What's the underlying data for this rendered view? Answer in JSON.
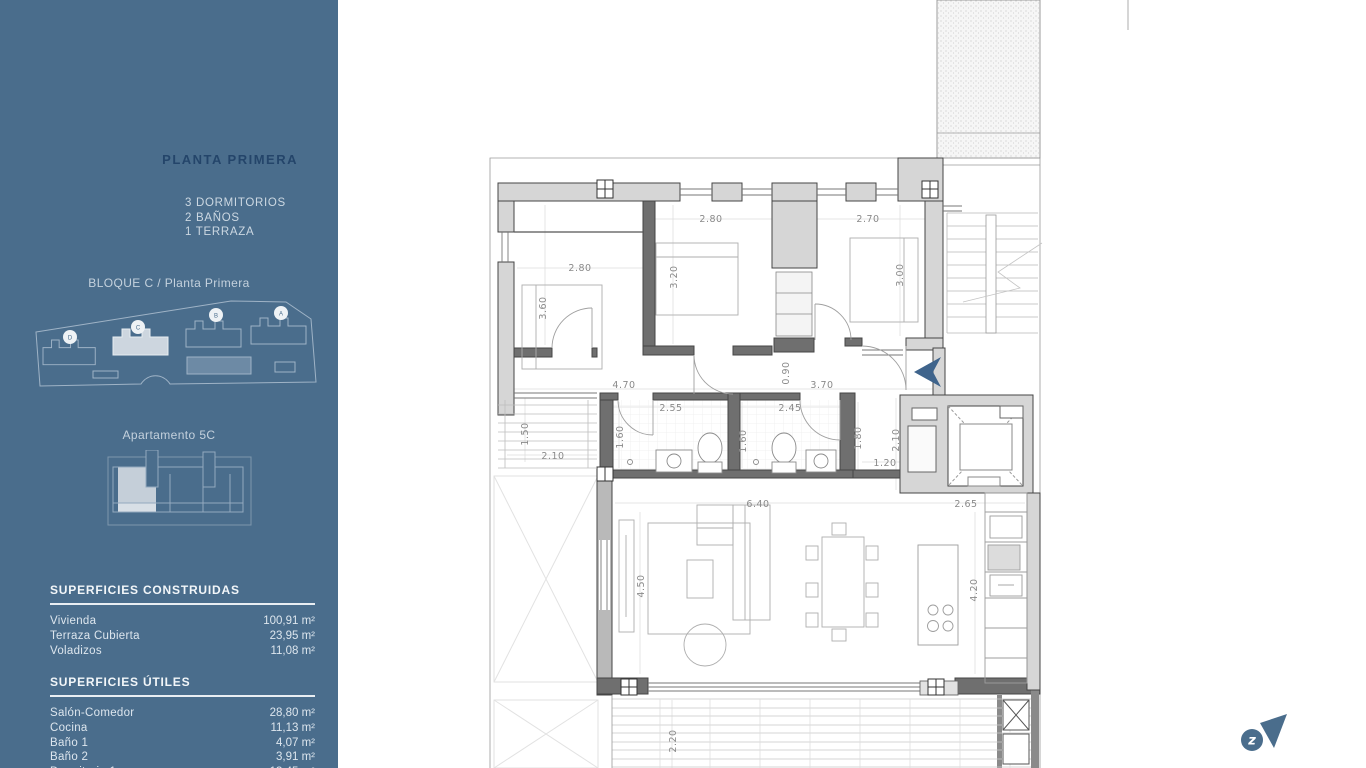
{
  "sidebar": {
    "title": "PLANTA PRIMERA",
    "specs": [
      "3 DORMITORIOS",
      "2 BAÑOS",
      "1 TERRAZA"
    ],
    "block_label": "BLOQUE C / Planta Primera",
    "site_blocks": [
      "D",
      "C",
      "B",
      "A"
    ],
    "apartment_label": "Apartamento 5C",
    "surfaces_built": {
      "heading": "SUPERFICIES CONSTRUIDAS",
      "rows": [
        {
          "label": "Vivienda",
          "value": "100,91 m²"
        },
        {
          "label": "Terraza Cubierta",
          "value": "23,95 m²"
        },
        {
          "label": "Voladizos",
          "value": "11,08 m²"
        }
      ]
    },
    "surfaces_useful": {
      "heading": "SUPERFICIES ÚTILES",
      "rows": [
        {
          "label": "Salón-Comedor",
          "value": "28,80 m²"
        },
        {
          "label": "Cocina",
          "value": "11,13 m²"
        },
        {
          "label": "Baño 1",
          "value": "4,07 m²"
        },
        {
          "label": "Baño 2",
          "value": "3,91 m²"
        },
        {
          "label": "Dormitorio 1",
          "value": "13,45 m²"
        }
      ]
    }
  },
  "floor_plan": {
    "dimension_labels": [
      {
        "v": "2.80",
        "x": 580,
        "y": 271,
        "r": 0
      },
      {
        "v": "3.60",
        "x": 546,
        "y": 308,
        "r": 1
      },
      {
        "v": "2.80",
        "x": 711,
        "y": 222,
        "r": 0
      },
      {
        "v": "3.20",
        "x": 677,
        "y": 277,
        "r": 1
      },
      {
        "v": "2.70",
        "x": 868,
        "y": 222,
        "r": 0
      },
      {
        "v": "3.00",
        "x": 903,
        "y": 275,
        "r": 1
      },
      {
        "v": "4.70",
        "x": 624,
        "y": 388,
        "r": 0
      },
      {
        "v": "0.90",
        "x": 789,
        "y": 373,
        "r": 1
      },
      {
        "v": "3.70",
        "x": 822,
        "y": 388,
        "r": 0
      },
      {
        "v": "2.55",
        "x": 671,
        "y": 411,
        "r": 0
      },
      {
        "v": "1.60",
        "x": 623,
        "y": 437,
        "r": 1
      },
      {
        "v": "2.45",
        "x": 790,
        "y": 411,
        "r": 0
      },
      {
        "v": "1.60",
        "x": 746,
        "y": 441,
        "r": 1
      },
      {
        "v": "1.80",
        "x": 861,
        "y": 438,
        "r": 1
      },
      {
        "v": "2.10",
        "x": 899,
        "y": 440,
        "r": 1
      },
      {
        "v": "1.20",
        "x": 885,
        "y": 466,
        "r": 0
      },
      {
        "v": "1.50",
        "x": 528,
        "y": 434,
        "r": 1
      },
      {
        "v": "2.10",
        "x": 553,
        "y": 459,
        "r": 0
      },
      {
        "v": "6.40",
        "x": 758,
        "y": 507,
        "r": 0
      },
      {
        "v": "4.50",
        "x": 644,
        "y": 586,
        "r": 1
      },
      {
        "v": "2.65",
        "x": 966,
        "y": 507,
        "r": 0
      },
      {
        "v": "4.20",
        "x": 977,
        "y": 590,
        "r": 1
      },
      {
        "v": "2.20",
        "x": 676,
        "y": 741,
        "r": 1
      }
    ]
  },
  "colors": {
    "sidebar_bg": "#4a6d8c",
    "title_navy": "#24456a",
    "light_text": "#ccd8e2",
    "highlight_fill": "#cdd6df",
    "wall_light": "#d6d6d6",
    "wall_dark": "#6f6f6f",
    "entrance_arrow": "#3f648c",
    "logo": "#4a6d8c"
  }
}
